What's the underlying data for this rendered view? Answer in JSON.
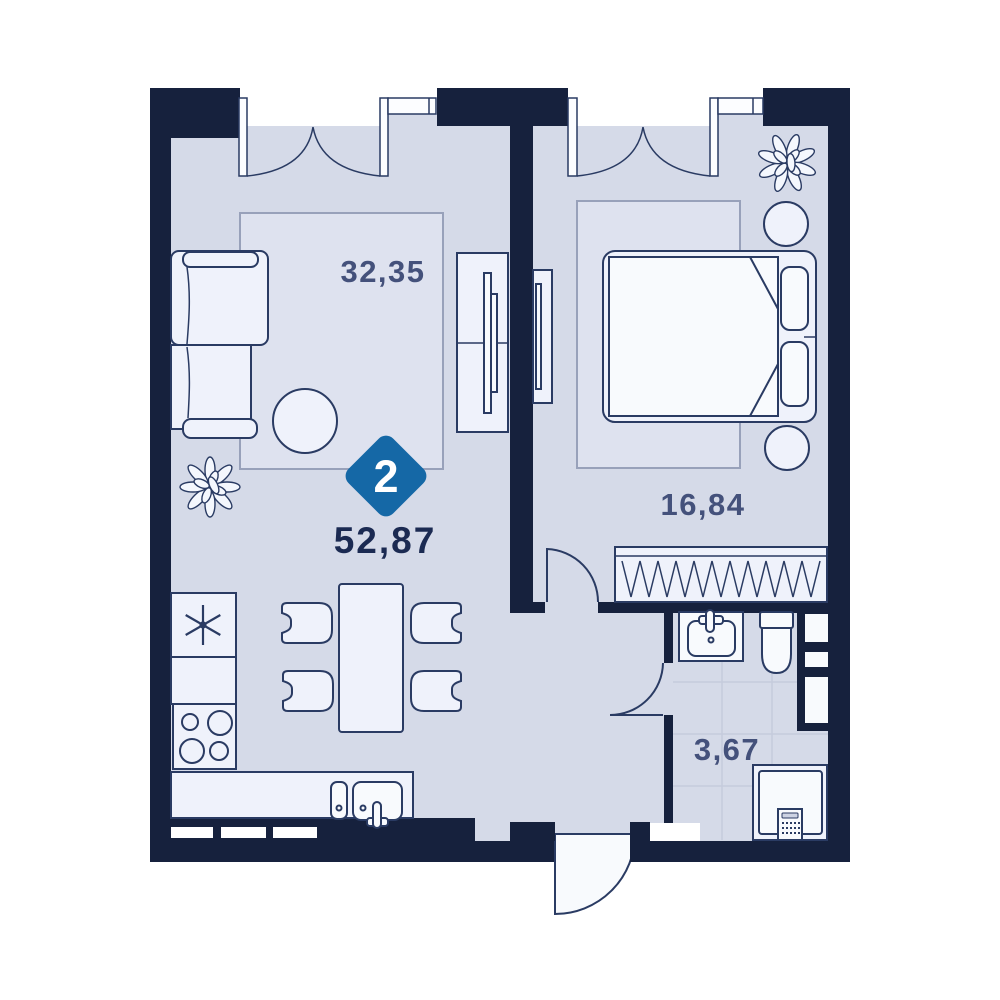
{
  "plan": {
    "badge": {
      "rooms_count": "2",
      "color": "#1568A6"
    },
    "total_area": "52,87",
    "rooms": [
      {
        "id": "living-kitchen",
        "area": "32,35"
      },
      {
        "id": "bedroom",
        "area": "16,84"
      },
      {
        "id": "bathroom",
        "area": "3,67"
      }
    ],
    "colors": {
      "wall": "#16213D",
      "floor": "#D5DAE8",
      "rug": "#DEE2EF",
      "furniture_fill": "#EFF2FB",
      "outline": "#2A3B63",
      "room_label": "#44517B",
      "total_label": "#1B2A52",
      "badge_blue": "#1568A6"
    }
  }
}
